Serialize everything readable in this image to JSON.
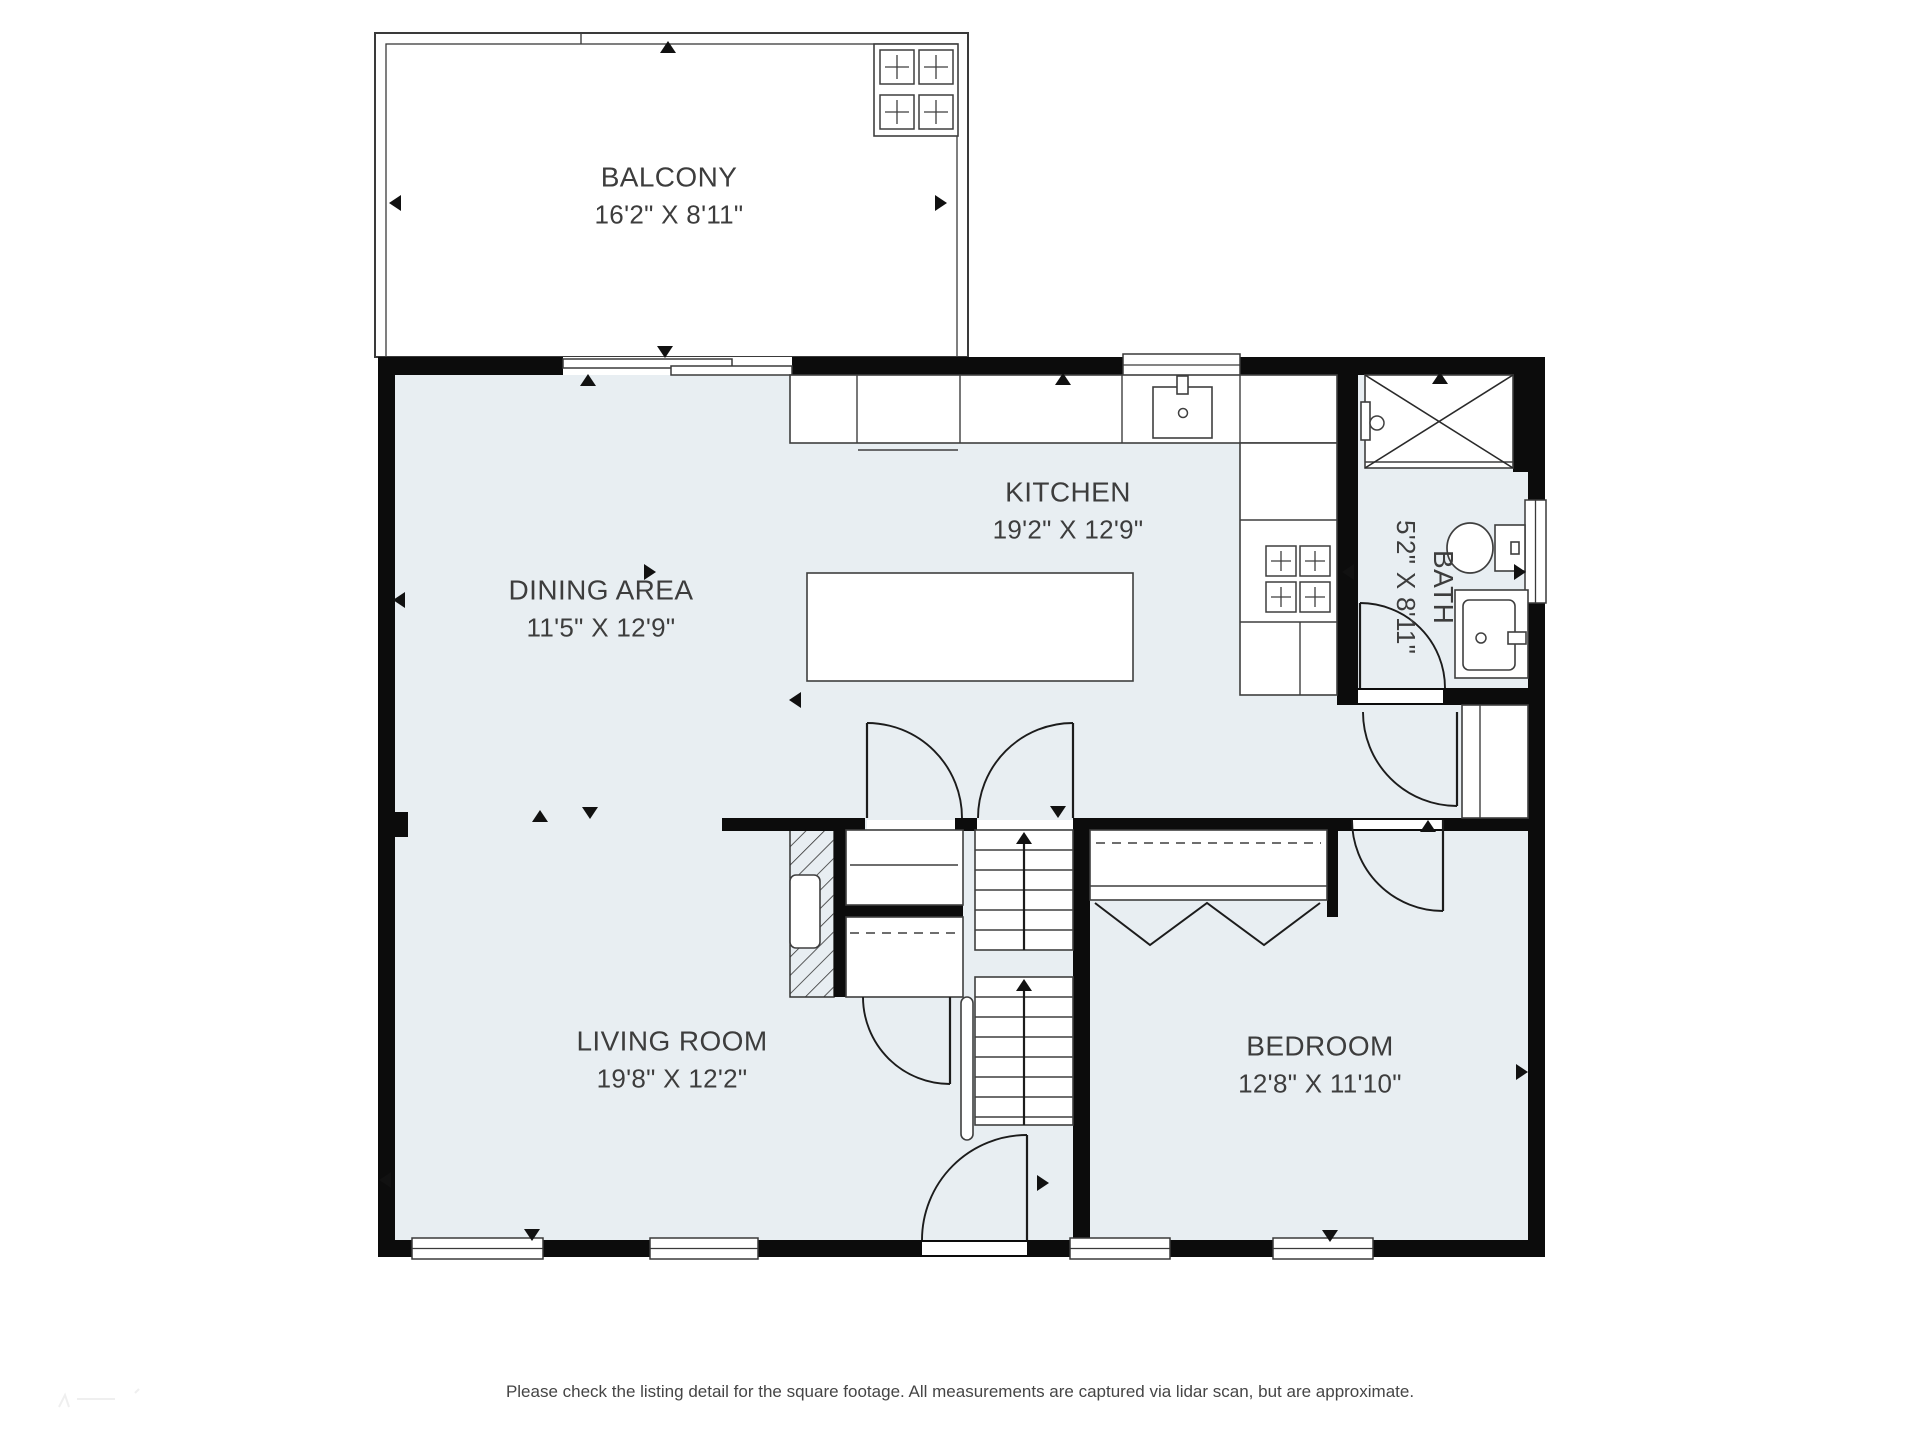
{
  "labels": {
    "balcony": {
      "name": "BALCONY",
      "dims": "16'2\" X 8'11\""
    },
    "kitchen": {
      "name": "KITCHEN",
      "dims": "19'2\" X 12'9\""
    },
    "dining": {
      "name": "DINING AREA",
      "dims": "11'5\" X 12'9\""
    },
    "living": {
      "name": "LIVING ROOM",
      "dims": "19'8\" X 12'2\""
    },
    "bedroom": {
      "name": "BEDROOM",
      "dims": "12'8\" X 11'10\""
    },
    "bath": {
      "name": "BATH",
      "dims": "5'2\" X 8'11\""
    }
  },
  "footer": "Please check the listing detail for the square footage. All measurements are captured via lidar scan, but are approximate.",
  "colors": {
    "wall": "#0c0c0c",
    "floor": "#e8eef2",
    "fixture_stroke": "#3f3f3f",
    "door_stroke": "#1c1c1c",
    "thin_stroke": "#3a3a3a",
    "text": "#3d3d3d"
  },
  "plan": {
    "floor": [
      395,
      375,
      1133,
      865
    ],
    "thin": [
      [
        375,
        33,
        593,
        324,
        2
      ],
      [
        386,
        44,
        571,
        313,
        1.3
      ]
    ],
    "hatch": [
      790,
      830,
      44,
      167
    ],
    "walls": [
      [
        378,
        357,
        1167,
        18
      ],
      [
        378,
        357,
        17,
        900
      ],
      [
        378,
        1240,
        1167,
        17
      ],
      [
        1528,
        357,
        17,
        900
      ],
      [
        1337,
        357,
        21,
        348
      ],
      [
        1513,
        357,
        32,
        115
      ],
      [
        1337,
        688,
        208,
        17
      ],
      [
        1077,
        818,
        468,
        13
      ],
      [
        722,
        818,
        143,
        13
      ],
      [
        955,
        818,
        22,
        13
      ],
      [
        1073,
        818,
        17,
        422
      ],
      [
        834,
        830,
        12,
        167
      ],
      [
        846,
        905,
        117,
        12
      ],
      [
        834,
        985,
        29,
        12
      ],
      [
        378,
        812,
        30,
        25
      ],
      [
        1327,
        830,
        11,
        87
      ]
    ],
    "openings": [
      [
        563,
        357,
        229,
        18
      ],
      [
        1358,
        690,
        85,
        13
      ],
      [
        1352,
        820,
        91,
        9
      ],
      [
        867,
        820,
        88,
        9
      ],
      [
        977,
        820,
        96,
        9
      ],
      [
        922,
        1242,
        105,
        13
      ]
    ],
    "windows": [
      [
        1123,
        354,
        117,
        22
      ],
      [
        412,
        1238,
        131,
        21
      ],
      [
        650,
        1238,
        108,
        21
      ],
      [
        1070,
        1238,
        100,
        21
      ],
      [
        1273,
        1238,
        100,
        21
      ],
      [
        1525,
        500,
        21,
        103
      ]
    ],
    "panels": [
      [
        563,
        359,
        169,
        9
      ],
      [
        671,
        366,
        121,
        9
      ]
    ],
    "whites": [
      [
        790,
        375,
        547,
        68
      ],
      [
        1240,
        443,
        97,
        252
      ],
      [
        807,
        573,
        326,
        108
      ],
      [
        1153,
        387,
        59,
        51
      ],
      [
        1177,
        376,
        11,
        18
      ],
      [
        1365,
        375,
        148,
        93
      ],
      [
        1361,
        402,
        9,
        38
      ],
      [
        1495,
        525,
        30,
        46
      ],
      [
        1511,
        542,
        8,
        12
      ],
      [
        1455,
        590,
        73,
        88
      ],
      [
        1463,
        600,
        52,
        70
      ],
      [
        790,
        875,
        30,
        73
      ],
      [
        846,
        830,
        117,
        75
      ],
      [
        846,
        917,
        117,
        80
      ],
      [
        1090,
        830,
        237,
        70
      ],
      [
        1462,
        705,
        66,
        113
      ],
      [
        975,
        830,
        98,
        120
      ],
      [
        975,
        977,
        98,
        148
      ],
      [
        961,
        997,
        12,
        143
      ],
      [
        874,
        44,
        84,
        92
      ],
      [
        1508,
        632,
        18,
        12
      ]
    ],
    "lines": [
      [
        857,
        375,
        857,
        443
      ],
      [
        960,
        375,
        960,
        443
      ],
      [
        1122,
        375,
        1122,
        443
      ],
      [
        1240,
        375,
        1240,
        443
      ],
      [
        858,
        450,
        958,
        450
      ],
      [
        1240,
        520,
        1337,
        520
      ],
      [
        1240,
        622,
        1337,
        622
      ],
      [
        1300,
        622,
        1300,
        695
      ],
      [
        850,
        865,
        958,
        865
      ],
      [
        1090,
        886,
        1327,
        886
      ],
      [
        1480,
        705,
        1480,
        818
      ],
      [
        1365,
        462,
        1513,
        462
      ],
      [
        975,
        850,
        1073,
        850
      ],
      [
        975,
        870,
        1073,
        870
      ],
      [
        975,
        890,
        1073,
        890
      ],
      [
        975,
        910,
        1073,
        910
      ],
      [
        975,
        930,
        1073,
        930
      ],
      [
        975,
        997,
        1073,
        997
      ],
      [
        975,
        1017,
        1073,
        1017
      ],
      [
        975,
        1037,
        1073,
        1037
      ],
      [
        975,
        1057,
        1073,
        1057
      ],
      [
        975,
        1077,
        1073,
        1077
      ],
      [
        975,
        1097,
        1073,
        1097
      ],
      [
        975,
        1117,
        1073,
        1117
      ],
      [
        581,
        33,
        581,
        44
      ]
    ],
    "leaf": [
      [
        867,
        723,
        867,
        818
      ],
      [
        1073,
        723,
        1073,
        818
      ],
      [
        1027,
        1135,
        1027,
        1240
      ],
      [
        950,
        997,
        950,
        1084
      ],
      [
        1360,
        603,
        1360,
        688
      ],
      [
        1457,
        712,
        1457,
        806
      ],
      [
        1443,
        820,
        1443,
        911
      ],
      [
        1024,
        842,
        1024,
        950
      ],
      [
        1024,
        989,
        1024,
        1125
      ]
    ],
    "dashes": [
      [
        850,
        933,
        958,
        933
      ],
      [
        1096,
        843,
        1321,
        843
      ]
    ],
    "cross": [
      [
        1365,
        375,
        1513,
        468
      ],
      [
        1365,
        468,
        1513,
        375
      ]
    ],
    "poly": [
      [
        1095,
        903,
        1150,
        945,
        1207,
        903,
        1264,
        945,
        1320,
        903
      ]
    ],
    "arcs": [
      "M867 723 A95 95 0 0 1 962 818",
      "M1073 723 A95 95 0 0 0 978 818",
      "M1027 1135 A105 105 0 0 0 922 1240",
      "M863 997 A87 87 0 0 0 950 1084",
      "M1360 603 A85 85 0 0 1 1445 688",
      "M1363 712 A94 94 0 0 0 1457 806",
      "M1352 820 A91 91 0 0 0 1443 911"
    ],
    "burners": [
      [
        1266,
        546,
        30
      ],
      [
        1300,
        546,
        30
      ],
      [
        1266,
        582,
        30
      ],
      [
        1300,
        582,
        30
      ],
      [
        880,
        50,
        34
      ],
      [
        919,
        50,
        34
      ],
      [
        880,
        95,
        34
      ],
      [
        919,
        95,
        34
      ]
    ],
    "circles": [
      [
        1183,
        413,
        4.5
      ],
      [
        1481,
        638,
        5
      ],
      [
        1377,
        423,
        7
      ]
    ],
    "ellipses": [
      [
        1470,
        548,
        23,
        25
      ]
    ],
    "markers": [
      [
        "u",
        668,
        47
      ],
      [
        "u",
        588,
        380
      ],
      [
        "u",
        1063,
        379
      ],
      [
        "u",
        1440,
        378
      ],
      [
        "u",
        540,
        816
      ],
      [
        "u",
        1428,
        826
      ],
      [
        "u",
        1024,
        838
      ],
      [
        "u",
        1024,
        985
      ],
      [
        "d",
        665,
        352
      ],
      [
        "d",
        590,
        813
      ],
      [
        "d",
        1058,
        812
      ],
      [
        "d",
        532,
        1235
      ],
      [
        "d",
        1330,
        1236
      ],
      [
        "l",
        395,
        203
      ],
      [
        "l",
        399,
        600
      ],
      [
        "l",
        795,
        700
      ],
      [
        "l",
        385,
        1180
      ],
      [
        "l",
        1348,
        572
      ],
      [
        "r",
        941,
        203
      ],
      [
        "r",
        650,
        572
      ],
      [
        "r",
        1043,
        1183
      ],
      [
        "r",
        1522,
        1072
      ],
      [
        "r",
        1520,
        572
      ]
    ]
  }
}
